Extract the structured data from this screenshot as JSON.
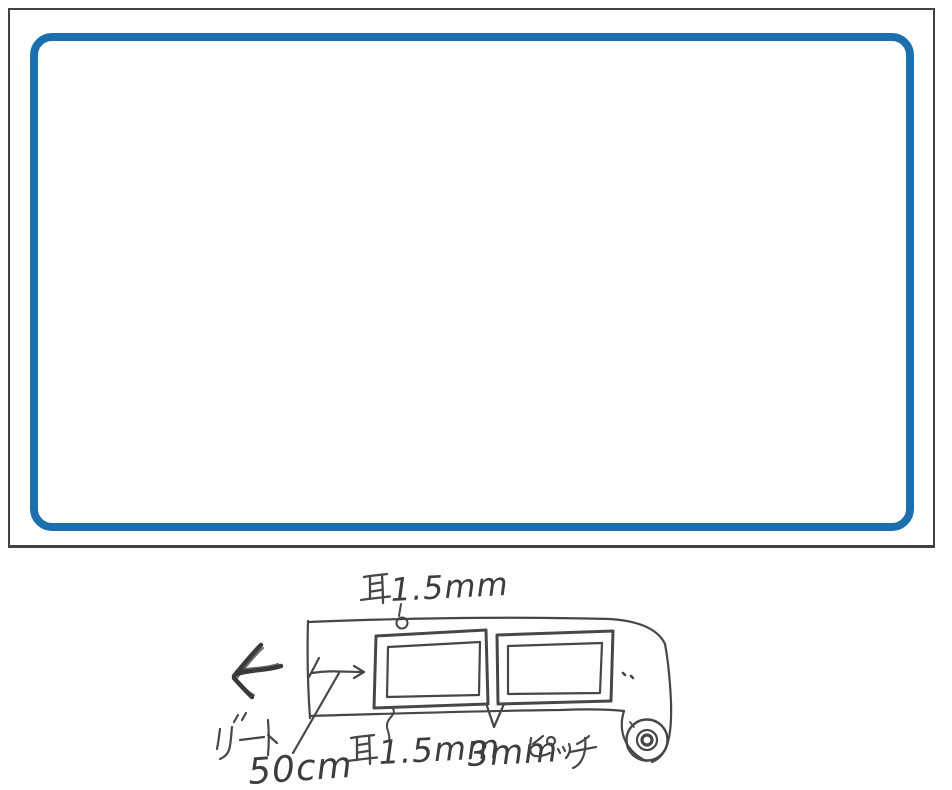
{
  "scan": {
    "paper_color": "#ffffff",
    "outline_color": "#424242"
  },
  "label_proof": {
    "frame_color": "#1c6fae",
    "background": "#ffffff"
  },
  "sketch": {
    "ink_color": "#474747",
    "annotations": {
      "ear_top": {
        "kanji": "耳",
        "value": "1.5mm"
      },
      "lead": {
        "kana": "リード",
        "value": "50cm"
      },
      "ear_bottom": {
        "kanji": "耳",
        "value": "1.5mm"
      },
      "pitch": {
        "value": "3mm",
        "kana": "ピッチ"
      }
    }
  }
}
